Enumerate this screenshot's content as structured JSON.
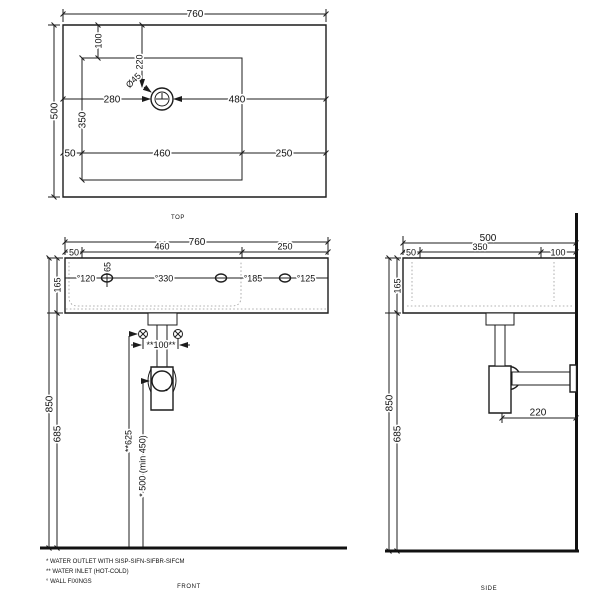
{
  "top_view": {
    "label": "TOP",
    "width": "760",
    "height": "500",
    "bowl_top_offset": "100",
    "hole_from_top": "220",
    "hole_diameter": "Ø45",
    "hole_from_left": "280",
    "hole_to_right": "480",
    "bowl_depth": "350",
    "left_gap": "50",
    "bowl_width": "460",
    "right_gap": "250"
  },
  "front_view": {
    "label": "FRONT",
    "width": "760",
    "left_gap": "50",
    "bowl_width": "460",
    "right_gap": "250",
    "height": "165",
    "fixing_offset": "65",
    "fixing_left": "°120",
    "fixing_span": "°330",
    "fixing_gap": "°185",
    "fixing_right": "°125",
    "inlet_spacing": "**100**",
    "inlet_height": "**625",
    "outlet_height": "* 500 (min 450)",
    "total_height": "850",
    "underside_height": "685"
  },
  "side_view": {
    "label": "SIDE",
    "depth": "500",
    "front_gap": "50",
    "bowl_depth": "350",
    "back_gap": "100",
    "height": "165",
    "total_height": "850",
    "underside_height": "685",
    "trap_to_wall": "220"
  },
  "footnotes": {
    "outlet": "*  WATER OUTLET WITH SISP-SIFN-SIFBR-SIFCM",
    "inlet": "** WATER INLET  (HOT-COLD)",
    "fixings": "°  WALL FIXINGS"
  }
}
